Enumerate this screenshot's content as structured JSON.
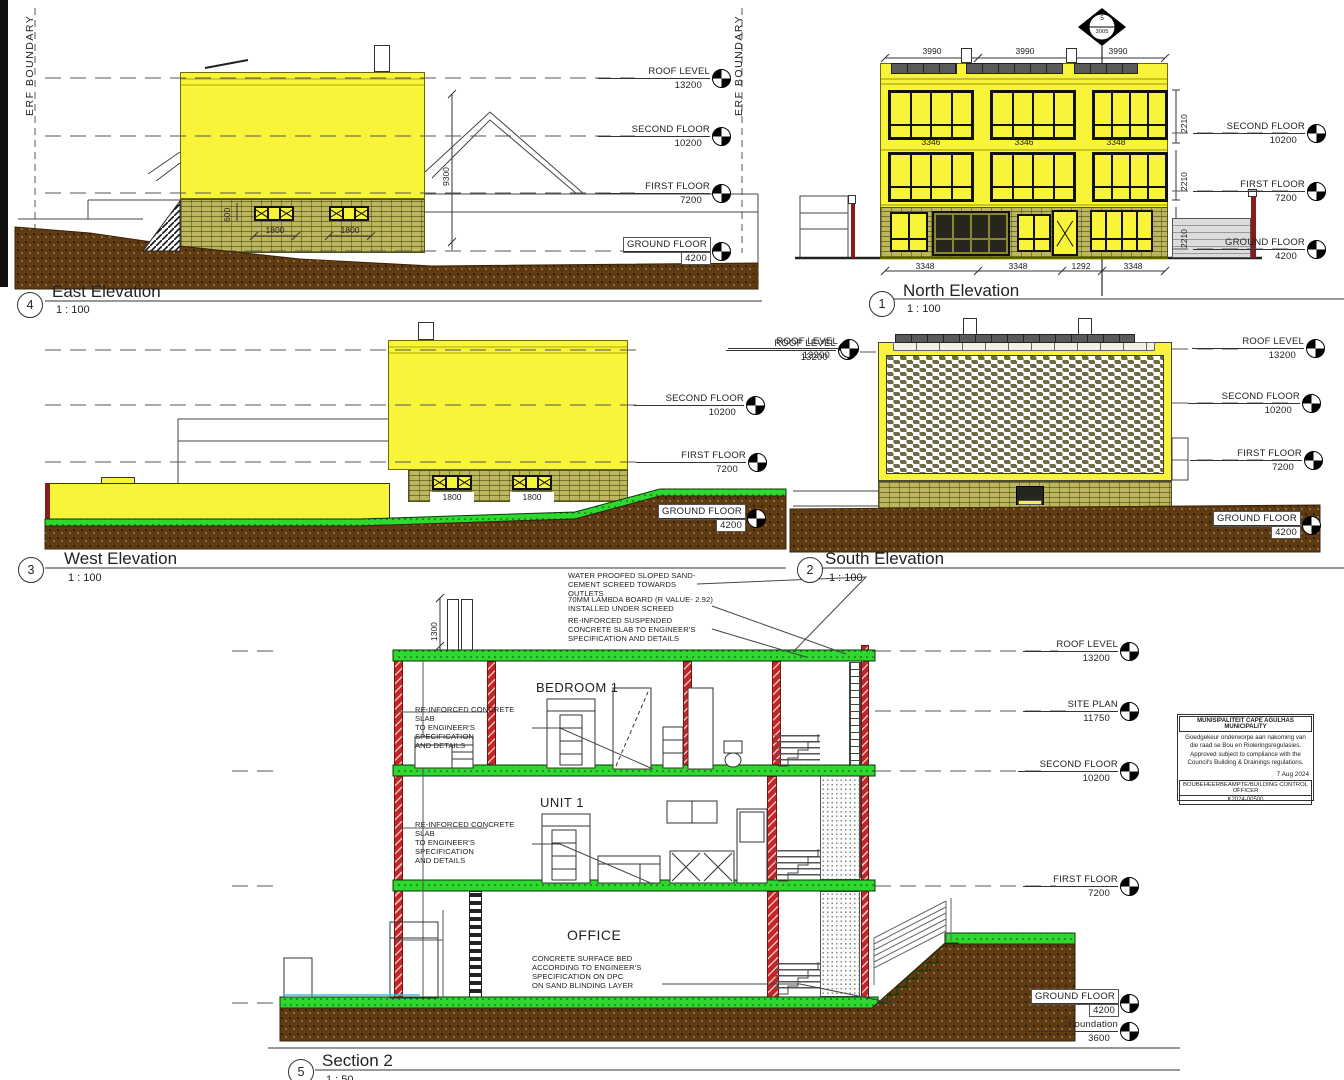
{
  "colors": {
    "building_yellow": "#f7f43a",
    "brick_khaki": "#bcb75f",
    "earth_brown": "#5d3a12",
    "slab_green": "#2fd82f",
    "column_red": "#cc2a2a"
  },
  "panels": {
    "east": {
      "number": "4",
      "title": "East Elevation",
      "scale": "1 : 100",
      "erf_left": "ERF BOUNDARY",
      "erf_right": "ERF BOUNDARY",
      "levels": [
        {
          "label": "ROOF LEVEL",
          "value": "13200"
        },
        {
          "label": "SECOND FLOOR",
          "value": "10200"
        },
        {
          "label": "FIRST FLOOR",
          "value": "7200"
        },
        {
          "label": "GROUND FLOOR",
          "value": "4200"
        }
      ],
      "dims": {
        "w1": "1800",
        "w2": "1800",
        "sill": "600",
        "height": "9300"
      }
    },
    "north": {
      "number": "1",
      "title": "North Elevation",
      "scale": "1 : 100",
      "marker": {
        "top": "5",
        "bottom": "3005"
      },
      "top_dims": [
        "3990",
        "3990",
        "3990"
      ],
      "mid_dims": [
        "3346",
        "3346",
        "3348"
      ],
      "bottom_dims": [
        "3348",
        "3348",
        "1292",
        "3348"
      ],
      "side_dims": [
        "2210",
        "2210",
        "2210"
      ],
      "levels": [
        {
          "label": "SECOND FLOOR",
          "value": "10200"
        },
        {
          "label": "FIRST FLOOR",
          "value": "7200"
        },
        {
          "label": "GROUND FLOOR",
          "value": "4200"
        }
      ]
    },
    "west": {
      "number": "3",
      "title": "West Elevation",
      "scale": "1 : 100",
      "levels": [
        {
          "label": "ROOF LEVEL",
          "value": "13200"
        },
        {
          "label": "SECOND FLOOR",
          "value": "10200"
        },
        {
          "label": "FIRST FLOOR",
          "value": "7200"
        },
        {
          "label": "GROUND FLOOR",
          "value": "4200"
        }
      ],
      "dims": {
        "w1": "1800",
        "w2": "1800"
      }
    },
    "south": {
      "number": "2",
      "title": "South Elevation",
      "scale": "1 : 100",
      "left_level": {
        "label": "ROOF LEVEL",
        "value": "13200"
      },
      "levels": [
        {
          "label": "ROOF LEVEL",
          "value": "13200"
        },
        {
          "label": "SECOND FLOOR",
          "value": "10200"
        },
        {
          "label": "FIRST FLOOR",
          "value": "7200"
        },
        {
          "label": "GROUND FLOOR",
          "value": "4200"
        }
      ]
    },
    "section": {
      "number": "5",
      "title": "Section 2",
      "scale": "1 : 50",
      "rooms": [
        "BEDROOM 1",
        "UNIT 1",
        "OFFICE"
      ],
      "dims": {
        "parapet": "1300"
      },
      "annotations": {
        "roof1": "WATER PROOFED SLOPED SAND-\nCEMENT SCREED TOWARDS OUTLETS",
        "roof2": "70MM LAMBDA BOARD (R VALUE- 2.92)\nINSTALLED UNDER SCREED",
        "roof3": "RE-INFORCED SUSPENDED\nCONCRETE SLAB TO ENGINEER'S\nSPECIFICATION AND DETAILS",
        "slab_upper": "RE-INFORCED CONCRETE SLAB\nTO ENGINEER'S SPECIFICATION\nAND DETAILS",
        "slab_lower": "RE-INFORCED CONCRETE SLAB\nTO ENGINEER'S SPECIFICATION\nAND DETAILS",
        "surface_bed": "CONCRETE SURFACE BED\nACCORDING TO ENGINEER'S\nSPECIFICATION ON DPC\nON SAND BLINDING LAYER"
      },
      "levels": [
        {
          "label": "ROOF LEVEL",
          "value": "13200"
        },
        {
          "label": "SITE PLAN",
          "value": "11750"
        },
        {
          "label": "SECOND FLOOR",
          "value": "10200"
        },
        {
          "label": "FIRST FLOOR",
          "value": "7200"
        },
        {
          "label": "GROUND FLOOR",
          "value": "4200"
        },
        {
          "label": "Foundation",
          "value": "3600"
        }
      ]
    }
  },
  "stamp": {
    "title": "MUNISIPALITEIT CAPE AGULHAS MUNICIPALITY",
    "body": "Goedgekeur onderworpe aan nakoming van\ndie raad se Bou en Rioleringsregulasies.\nApproved subject to compliance with the\nCouncil's Building & Drainings regulations.",
    "date": "7 Aug 2024",
    "officer": "BOUBEHEERBEAMPTE/BUILDING CONTROL OFFICER",
    "ref": "K2024-00500"
  }
}
